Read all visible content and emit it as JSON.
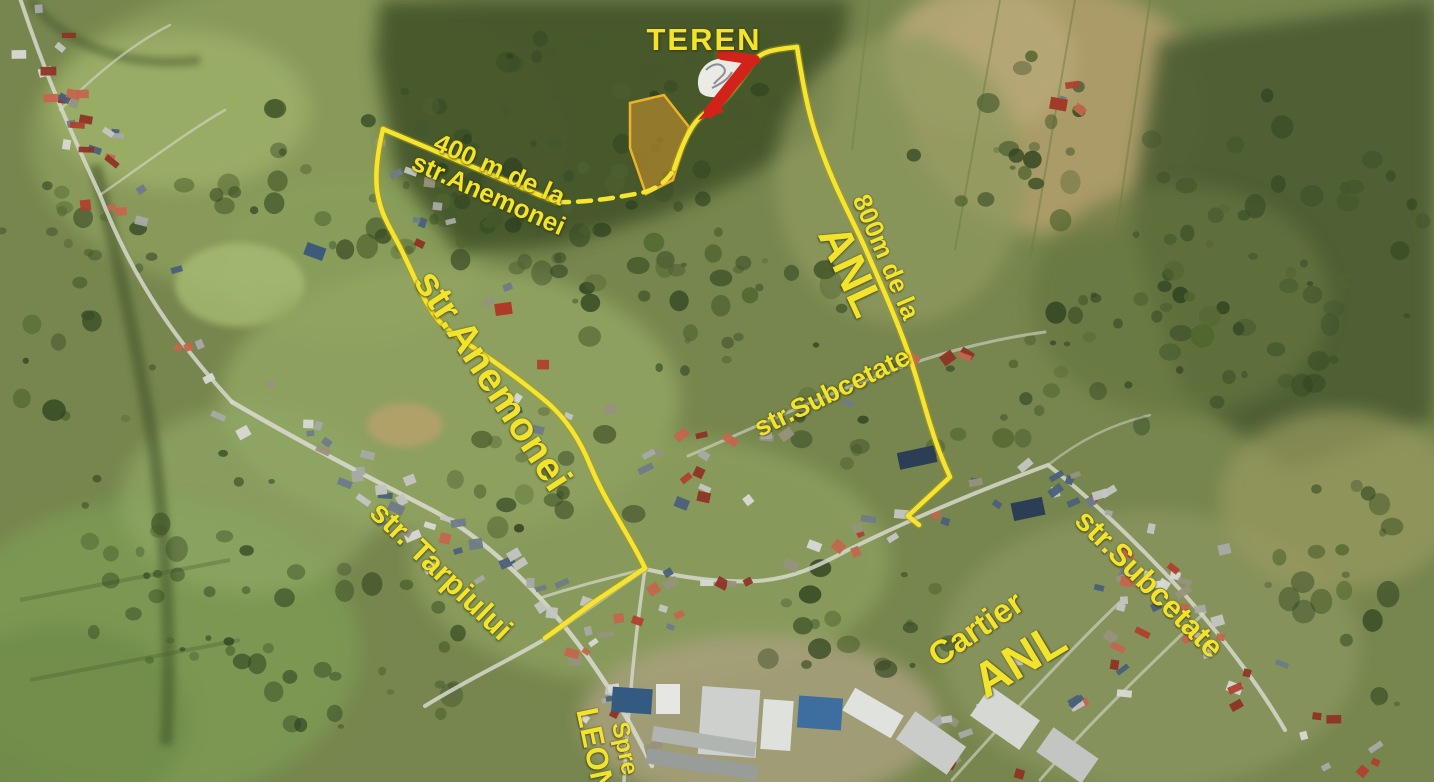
{
  "map": {
    "kind": "annotated-satellite-map",
    "labels": {
      "teren": "TEREN",
      "distance_anemonei_line1": "400 m de la",
      "distance_anemonei_line2": "str.Anemonei",
      "street_anemonei": "str.Anemonei",
      "distance_anl_line1": "800m de la",
      "distance_anl_line2": "ANL",
      "street_subcetate_mid": "str.Subcetate",
      "street_tarpiului": "str. Tarpiului",
      "district_line1": "Cartier",
      "district_line2": "ANL",
      "street_subcetate_bottom": "str.Subcetate",
      "direction_line1": "Spre",
      "direction_line2": "LEONI"
    },
    "colors": {
      "annotation_yellow": "#f2e32c",
      "route_yellow": "#f5e531",
      "route_shadow": "#b49c12",
      "marker_red": "#d2231a",
      "parcel_stroke": "#eeb22a",
      "parcel_fill": "rgba(224,154,44,0.5)"
    }
  }
}
